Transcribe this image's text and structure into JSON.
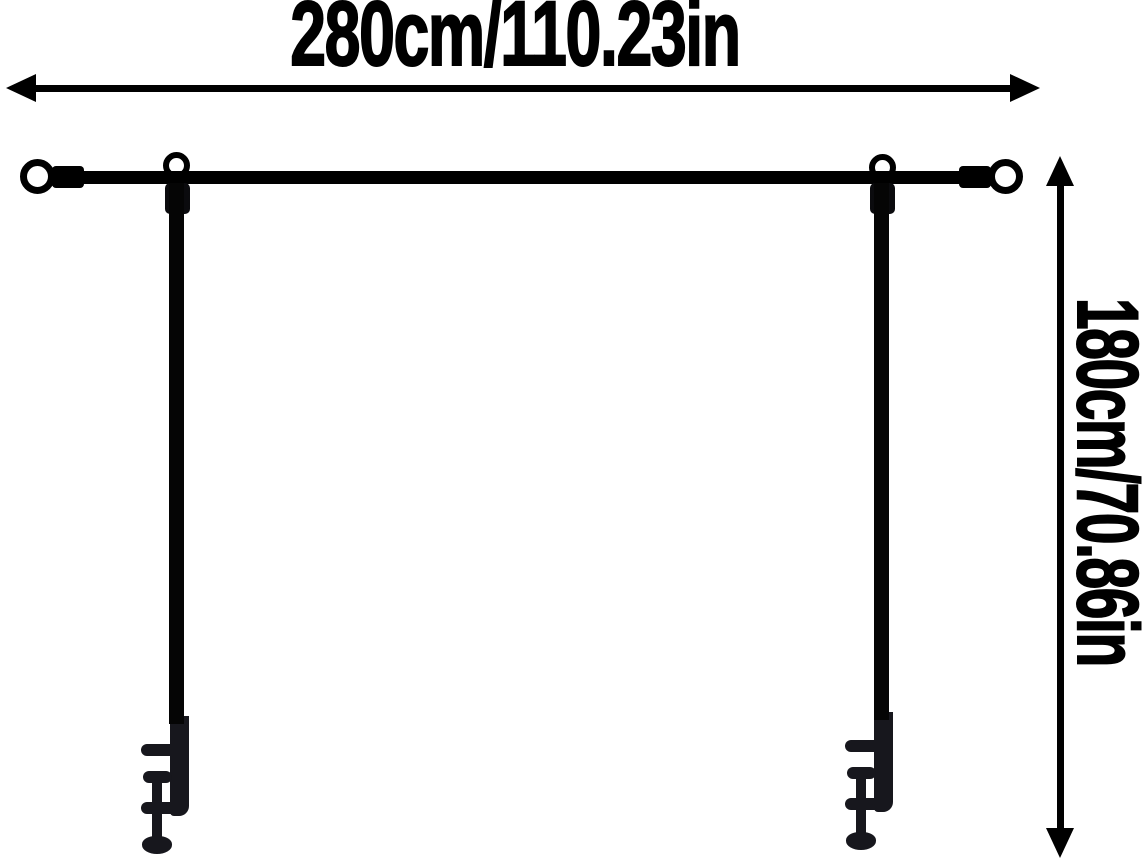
{
  "page": {
    "background": "#ffffff",
    "ink_color": "#000000",
    "clamp_color": "#17171d"
  },
  "dimensions": {
    "width_label": "280cm/110.23in",
    "height_label": "180cm/70.86in"
  },
  "figure": {
    "parts": [
      "crossbar-rod",
      "end-ring-left",
      "end-ring-right",
      "hanger-ring-left",
      "hanger-ring-right",
      "pole-left",
      "pole-right",
      "table-clamp-left",
      "table-clamp-right",
      "width-arrow",
      "height-arrow"
    ]
  }
}
